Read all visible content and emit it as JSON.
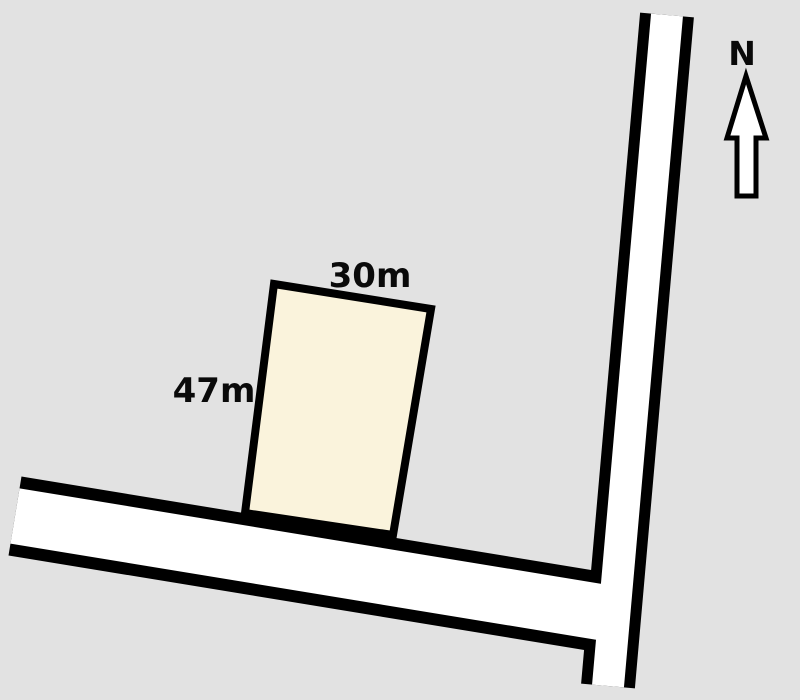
{
  "figure": {
    "width": 800,
    "height": 700,
    "background_color": "#E2E2E2",
    "outline_color": "#000000",
    "text_color": "#0a0a0a"
  },
  "parcel": {
    "fill_color": "#FAF3DC",
    "stroke_width": 8,
    "corners": [
      [
        274,
        284
      ],
      [
        431,
        309
      ],
      [
        393,
        535
      ],
      [
        245,
        513
      ]
    ],
    "top_dimension": {
      "label": "30m",
      "x": 370,
      "y": 287,
      "font_size": 34
    },
    "side_dimension": {
      "label": "47m",
      "x": 214,
      "y": 402,
      "font_size": 34
    }
  },
  "roads": [
    {
      "name": "vertical-road",
      "x1": 667,
      "y1": 15,
      "x2": 608,
      "y2": 686,
      "casing_width": 54,
      "surface_width": 32,
      "surface_color": "#FFFFFF"
    },
    {
      "name": "horizontal-road",
      "x1": 15,
      "y1": 516,
      "x2": 612,
      "y2": 614,
      "casing_width": 80,
      "surface_width": 56,
      "surface_color": "#FFFFFF"
    }
  ],
  "north_arrow": {
    "label": "N",
    "label_x": 742,
    "label_y": 65,
    "label_font_size": 33,
    "fill_color": "#FFFFFF",
    "stroke_width": 5,
    "points": [
      [
        746,
        76
      ],
      [
        766,
        138
      ],
      [
        756,
        138
      ],
      [
        756,
        196
      ],
      [
        737,
        196
      ],
      [
        737,
        138
      ],
      [
        727,
        138
      ]
    ]
  }
}
